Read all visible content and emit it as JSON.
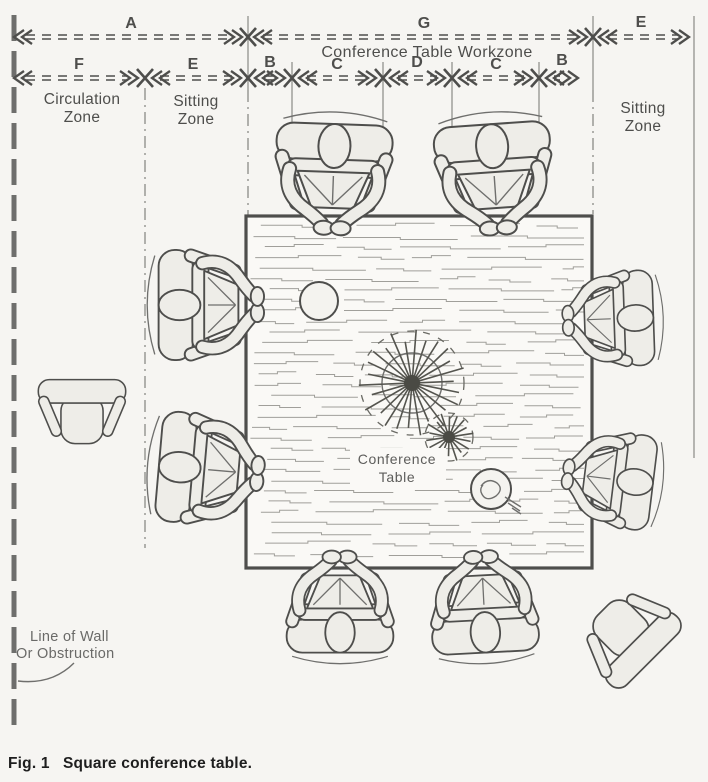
{
  "colors": {
    "ink": "#4e4e4c",
    "ink2": "#6f6f6d",
    "ink3": "#8a8a86",
    "fill": "#eeede8",
    "paper": "#f6f5f2",
    "grain": "#a09f9a",
    "cap": "#1e1e1e"
  },
  "dimension_rows": {
    "row1": {
      "labels": [
        "A",
        "G",
        "E"
      ],
      "sublabel": "Conference Table Workzone"
    },
    "row2": {
      "labels": [
        "F",
        "E",
        "B",
        "C",
        "D",
        "C",
        "B"
      ]
    }
  },
  "zones": {
    "circulation": {
      "line1": "Circulation",
      "line2": "Zone"
    },
    "sitting_left": {
      "line1": "Sitting",
      "line2": "Zone"
    },
    "sitting_right": {
      "line1": "Sitting",
      "line2": "Zone"
    }
  },
  "table_label": {
    "line1": "Conference",
    "line2": "Table"
  },
  "wall_label": {
    "line1": "Line of Wall",
    "line2": "Or Obstruction"
  },
  "caption": {
    "fig": "Fig. 1",
    "text": "Square conference table."
  }
}
